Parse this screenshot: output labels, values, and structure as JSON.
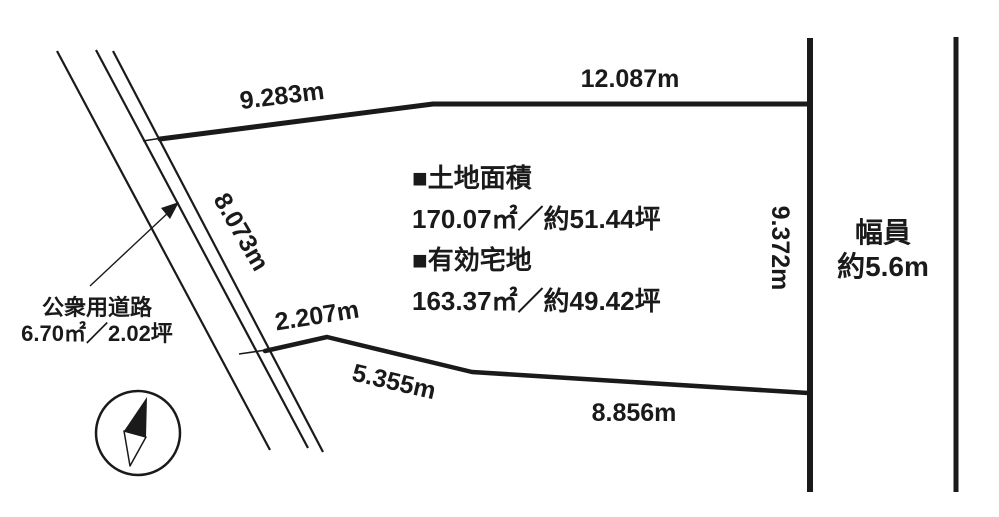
{
  "figure": {
    "type": "land-plot-survey-diagram",
    "background_color": "#ffffff",
    "line_color": "#1a1a1a"
  },
  "boundary_measurements": {
    "top_left_edge": "9.283m",
    "top_right_edge": "12.087m",
    "west_road_edge": "8.073m",
    "southwest_edge": "2.207m",
    "south_left_edge": "5.355m",
    "south_right_edge": "8.856m",
    "east_edge": "9.372m"
  },
  "area_info": {
    "land_area_heading": "■土地面積",
    "land_area_value": "170.07㎡／約51.44坪",
    "effective_area_heading": "■有効宅地",
    "effective_area_value": "163.37㎡／約49.42坪"
  },
  "public_road": {
    "name": "公衆用道路",
    "area": "6.70㎡／2.02坪"
  },
  "road_width": {
    "heading": "幅員",
    "value": "約5.6m"
  }
}
